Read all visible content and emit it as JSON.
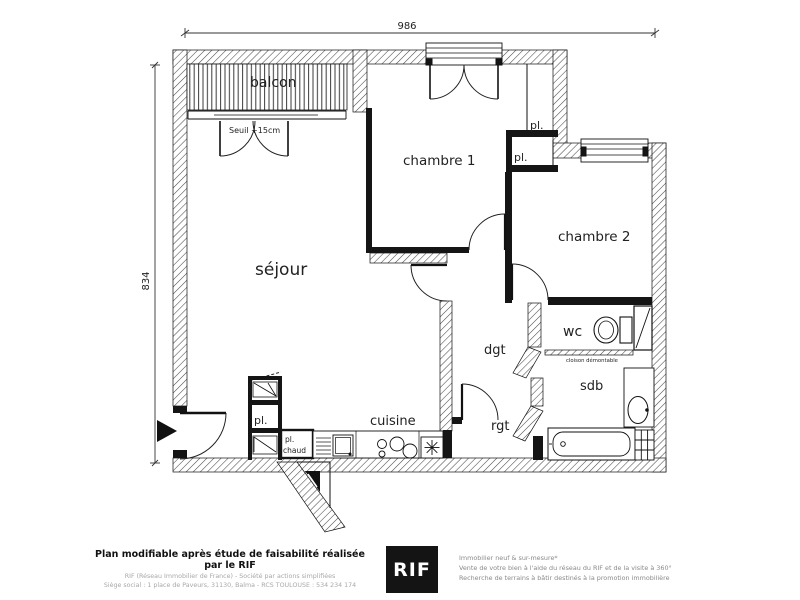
{
  "colors": {
    "line": "#1a1a1a",
    "hatch": "#444444",
    "logo_bg": "#141414",
    "muted_text": "#8a8a8a"
  },
  "plan": {
    "dim_width": "986",
    "dim_height": "834",
    "rooms": {
      "balcon": "balcon",
      "sejour": "séjour",
      "chambre1": "chambre 1",
      "chambre2": "chambre 2",
      "cuisine": "cuisine",
      "dgt": "dgt",
      "rgt": "rgt",
      "wc": "wc",
      "sdb": "sdb"
    },
    "closets": {
      "pl_chambre1": "pl.",
      "pl_chambre2": "pl.",
      "pl_sejour": "pl.",
      "pl_chaud_l1": "pl.",
      "pl_chaud_l2": "chaud"
    },
    "annotations": {
      "seuil": "Seuil +15cm",
      "cloison": "cloison démontable"
    }
  },
  "footer": {
    "left": {
      "title": "Plan modifiable après étude de faisabilité réalisée par le RIF",
      "line1": "RIF (Réseau Immobilier de France) - Société par actions simplifiées",
      "line2": "Siège social : 1 place de Paveurs, 31130, Balma - RCS TOULOUSE : 534 234 174"
    },
    "logo": "RIF",
    "right": {
      "line1": "Immobilier neuf & sur-mesure*",
      "line2": "Vente de votre bien à l'aide du réseau du RIF et de la visite à 360°",
      "line3": "Recherche de terrains à bâtir destinés à la promotion immobilière"
    }
  }
}
